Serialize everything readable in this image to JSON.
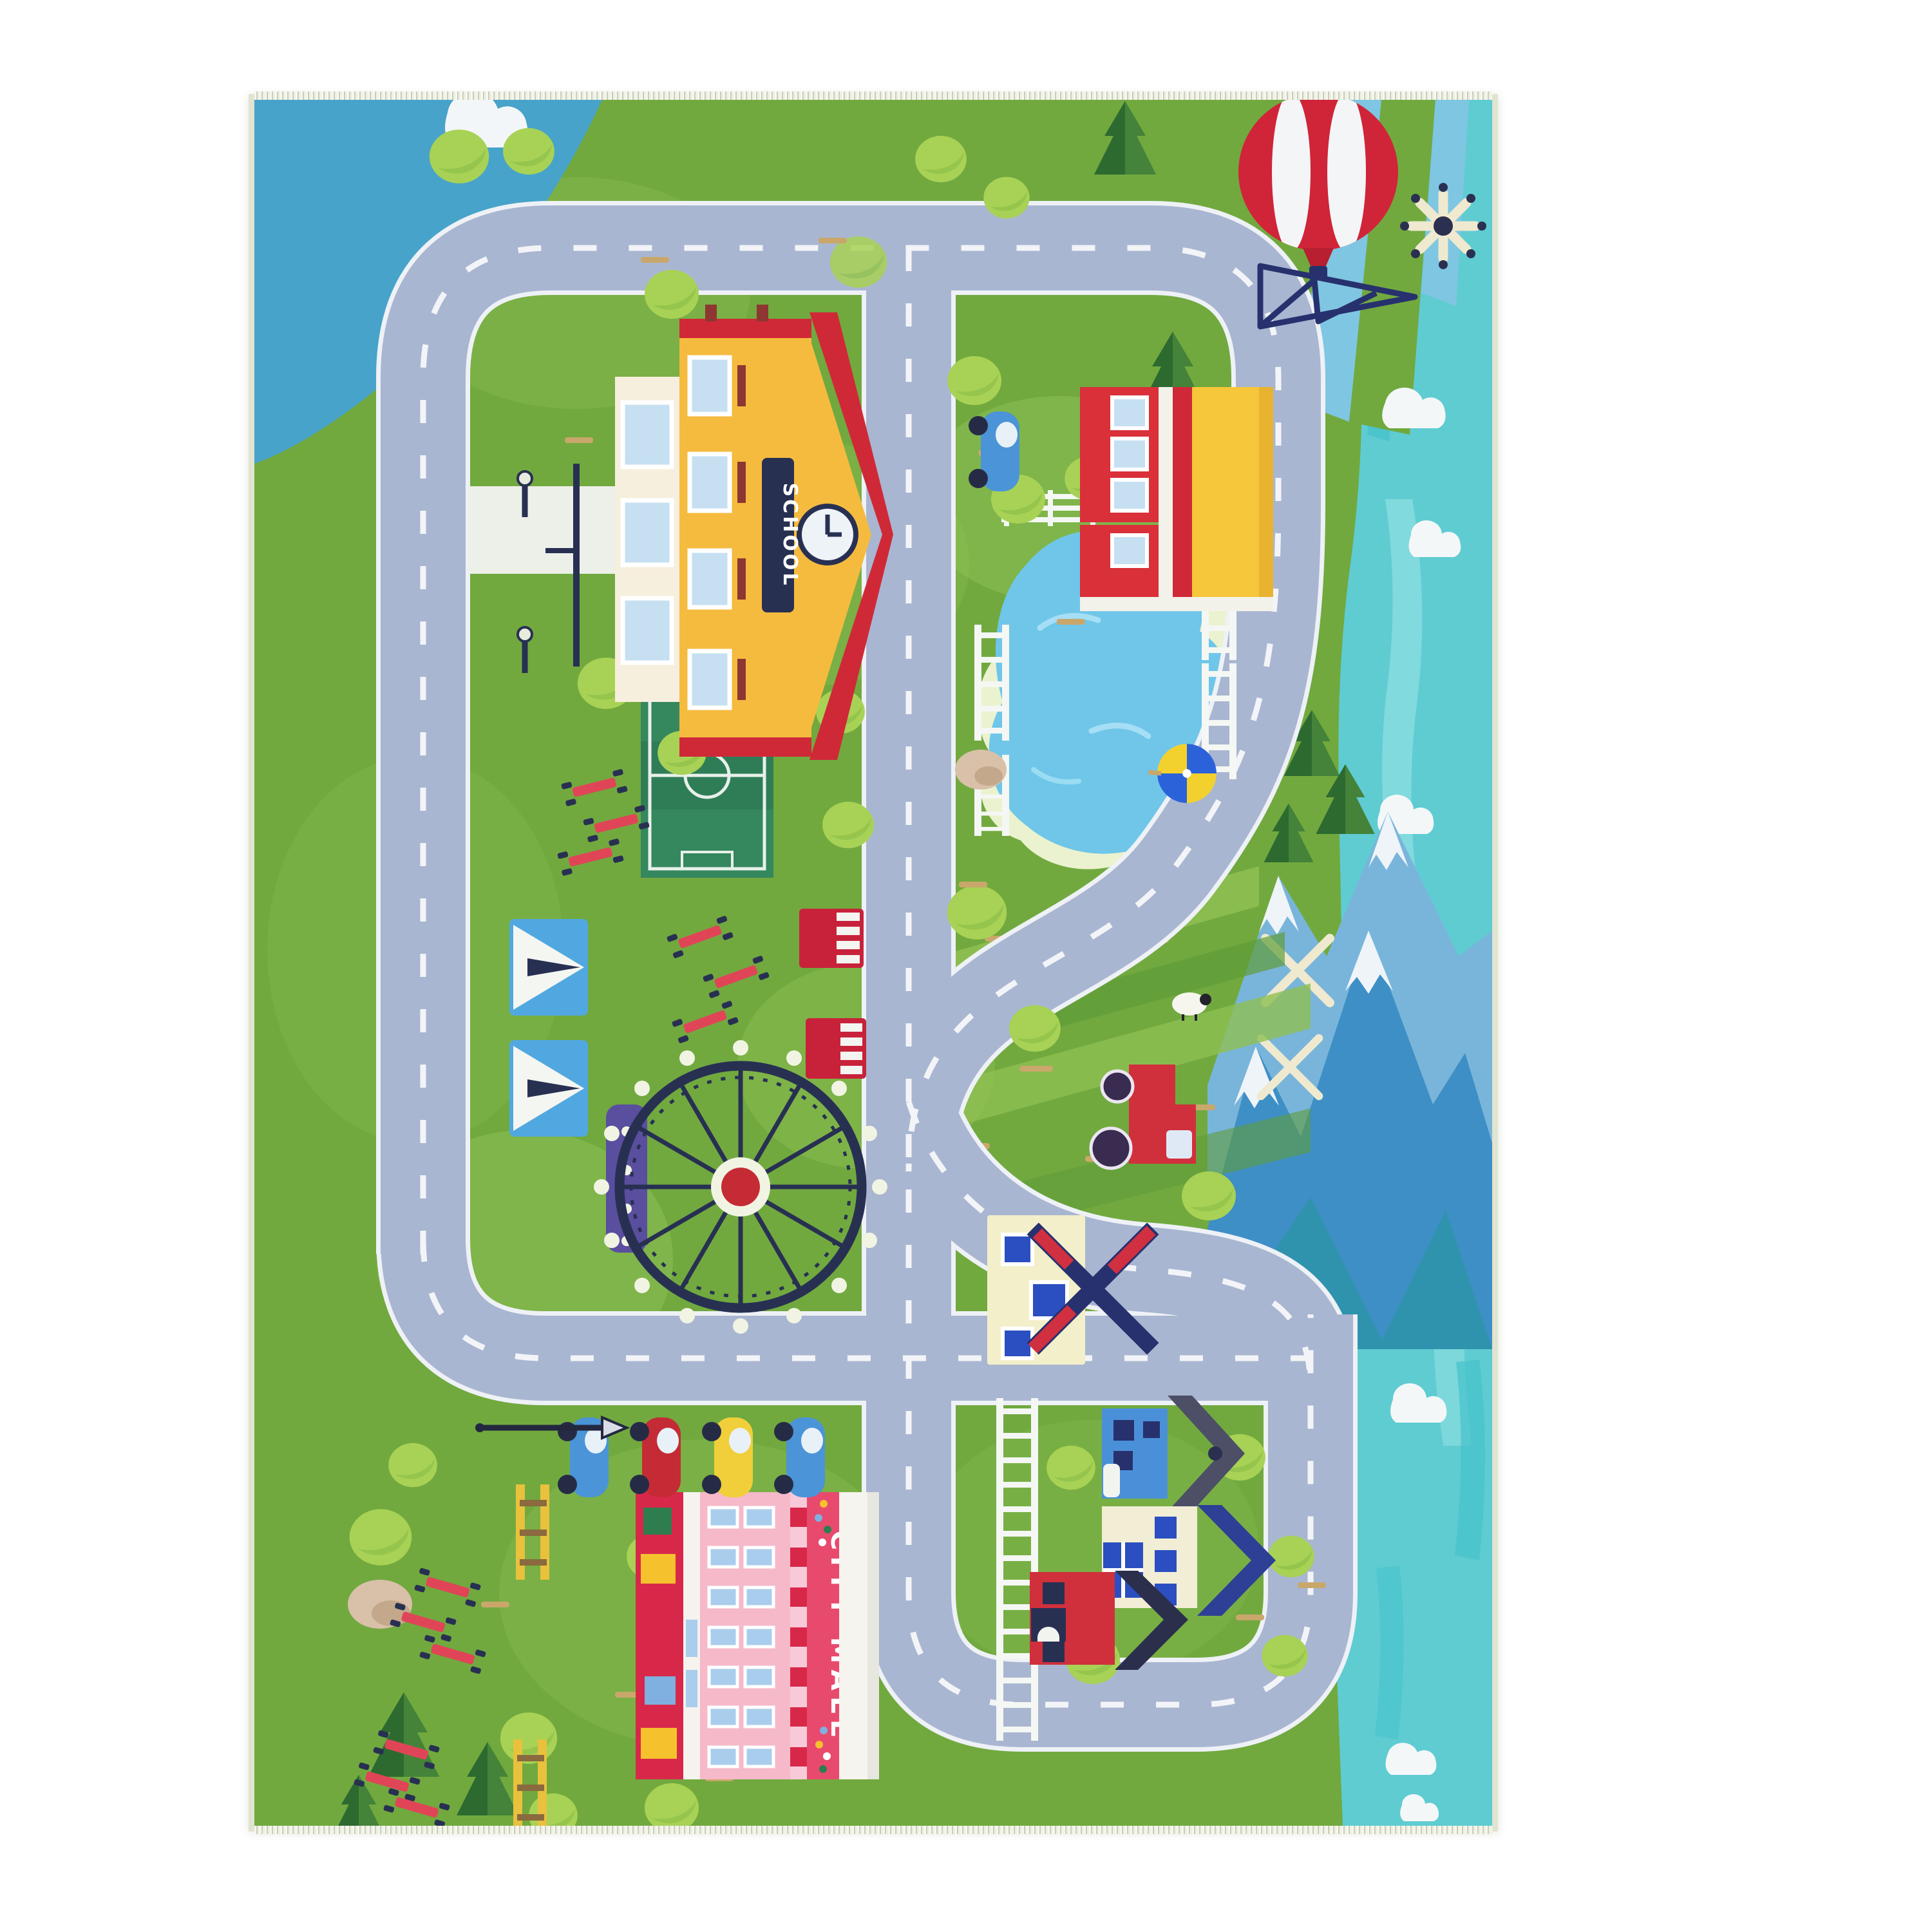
{
  "scene": {
    "type": "product-photo",
    "subject": "children's city road play rug seen from above",
    "background_color": "#ffffff"
  },
  "rug": {
    "labels": {
      "school_sign": "SCHOOL",
      "mall_sign": "CITY MALL"
    },
    "palette": {
      "grass": "#71a93f",
      "grass_light": "#8fbf52",
      "road": "#a9b6d1",
      "road_markings": "#f2f4f8",
      "river": "#5fccd2",
      "pond": "#6fc6e9",
      "sky_corner": "#47a3c9",
      "mountains": "#3e8fc6",
      "school_yellow": "#f5bb3f",
      "roof_red": "#cf2937",
      "mall_pink": "#f5b9ca",
      "mall_sign_red": "#e84a6e",
      "balloon_red": "#d02438",
      "navy": "#283052",
      "binding": "#e3e6d3"
    },
    "features": [
      "hot-air-balloon",
      "signal-tower",
      "dandelion-flower",
      "school-building",
      "shop-building",
      "blue-car",
      "pond",
      "bridge-fences",
      "beach-umbrella",
      "beach-ball",
      "soccer-field",
      "circus-tents",
      "food-stands",
      "ferris-wheel",
      "picnic-tables",
      "farm-fields",
      "red-tractor",
      "sheep",
      "dutch-windmill-house",
      "wind-turbines",
      "mountains",
      "river",
      "clouds",
      "city-mall-building",
      "parked-cars",
      "yellow-benches",
      "street-lamps",
      "railway-fence",
      "blue-house",
      "cream-house",
      "red-house",
      "pine-trees",
      "round-trees",
      "rocks"
    ]
  }
}
